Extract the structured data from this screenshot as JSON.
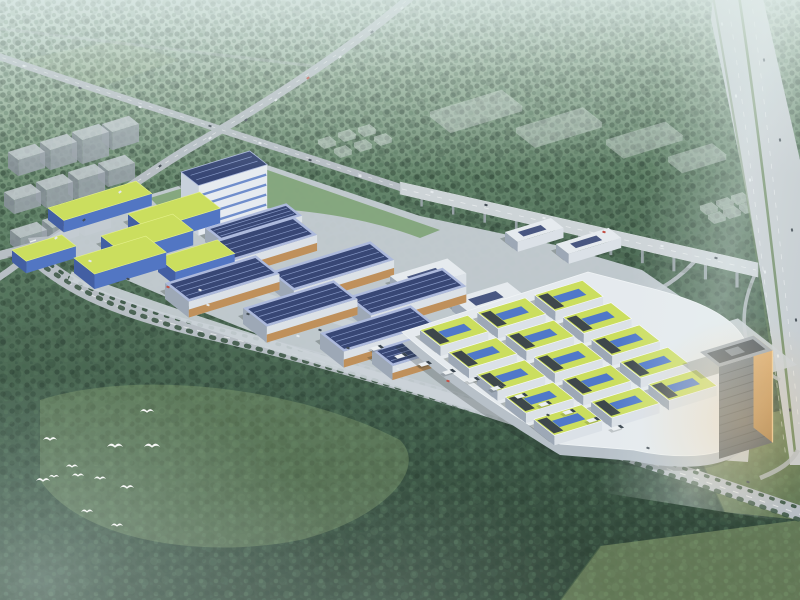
{
  "title": "Aerial rendering of industrial park campus with solar roofs",
  "colors": {
    "grad_0": "#c3d7cd",
    "grad_1": "#8fab90",
    "grad_2": "#5e8064",
    "grad_3": "#46654e",
    "grad_4": "#35523f",
    "grad_5": "#2b4132",
    "tree_a": "#243c2c",
    "tree_b": "#3e5f47",
    "tree_c": "#1f3527",
    "tree_d": "#4a6e52",
    "tree_e": "#31503c",
    "meadow": "#93ad74",
    "field_a": "#8ba268",
    "field_b": "#9cb173",
    "road": "#b6bdc3",
    "road_dash": "#ffffff",
    "highway": "#c6ccd1",
    "viaduct": "#ced4d8",
    "pier": "#98a2a8",
    "median": "#5d7c4e",
    "tree_row": "#2e4a36",
    "inner_road": "#ccd3d9",
    "ground": "#c6cdd4",
    "lawn": "#679455",
    "solar_roof": "#2e3d6e",
    "solar_line": "#8fa2d4",
    "solar_rim": "#aab7dd",
    "hall_facade": "#dde2e9",
    "facade_shade": "#9aa5b4",
    "wood": "#bf8b52",
    "yellow_roof": "#ccdf56",
    "yellow_edge": "#e8f486",
    "panel_blue": "#3f6cd0",
    "blue_facade": "#4a6fc2",
    "blue_facade_dark": "#3a57a0",
    "plinth": "#e8ecf0",
    "plinth_shade": "#b6bfc8",
    "unit_dark": "#2b3440",
    "tower_top": "#6a7580",
    "tower_bottom": "#46505a",
    "tower_floor": "#2e3842",
    "glow_top": "#e8b06a",
    "glow_bottom": "#a87a42",
    "tower_roof": "#9aa3ae",
    "tower_roof_dark": "#39424c",
    "ghost": "#dfe3e5",
    "ghost_edge": "#f2f6f6",
    "city_roof": "#c6ccd2",
    "city_face": "#9aa2ab",
    "city_face_dark": "#868e98",
    "shadow": "#14201a",
    "bird": "#ffffff",
    "truck": "#eef1f4",
    "truck_cab": "#2f3a44",
    "car_w": "#e8ecef",
    "car_d": "#3a434c",
    "car_r": "#c24538",
    "hq_facade": "#e9edf3",
    "hq_facade_side": "#c9d1dd",
    "hq_accent": "#c0392e",
    "plaza": "#c9d0d8"
  },
  "scene": {
    "buildings": [
      {
        "t": "yellowLong",
        "a": [
          48,
          208
        ],
        "l": 92,
        "w": 20,
        "h": 12
      },
      {
        "t": "yellowLong",
        "a": [
          12,
          250
        ],
        "l": 52,
        "w": 18,
        "h": 12
      },
      {
        "t": "solarHall",
        "a": [
          205,
          228
        ],
        "l": 85,
        "w": 20,
        "h": 14
      },
      {
        "t": "hq",
        "a": [
          181,
          172
        ],
        "l": 72,
        "w": 22,
        "h": 50
      },
      {
        "t": "yellowFactory",
        "a": [
          128,
          214
        ],
        "l": 75,
        "w": 26,
        "h": 15
      },
      {
        "t": "yellowFactory",
        "a": [
          101,
          236
        ],
        "l": 75,
        "w": 26,
        "h": 15
      },
      {
        "t": "yellowFactory",
        "a": [
          74,
          258
        ],
        "l": 75,
        "w": 26,
        "h": 15
      },
      {
        "t": "yellowFactory",
        "a": [
          158,
          258
        ],
        "l": 62,
        "w": 22,
        "h": 14
      },
      {
        "t": "solarHall",
        "a": [
          193,
          247
        ],
        "l": 105,
        "w": 30,
        "h": 16
      },
      {
        "t": "solarHall",
        "a": [
          270,
          272
        ],
        "l": 105,
        "w": 30,
        "h": 16
      },
      {
        "t": "solarHall",
        "a": [
          347,
          297
        ],
        "l": 100,
        "w": 30,
        "h": 16
      },
      {
        "t": "solarHall",
        "a": [
          165,
          283
        ],
        "l": 95,
        "w": 30,
        "h": 16
      },
      {
        "t": "solarHall",
        "a": [
          243,
          308
        ],
        "l": 95,
        "w": 30,
        "h": 16
      },
      {
        "t": "solarHall",
        "a": [
          320,
          333
        ],
        "l": 95,
        "w": 30,
        "h": 16
      },
      {
        "t": "whitePod",
        "a": [
          390,
          276
        ],
        "l": 60,
        "w": 24,
        "h": 12
      },
      {
        "t": "whitePod",
        "a": [
          452,
          299
        ],
        "l": 58,
        "w": 22,
        "h": 12
      },
      {
        "t": "solarHall",
        "a": [
          372,
          350
        ],
        "l": 70,
        "w": 26,
        "h": 14
      },
      {
        "t": "whitePod",
        "a": [
          505,
          232
        ],
        "l": 48,
        "w": 16,
        "h": 10
      },
      {
        "t": "whitePod",
        "a": [
          556,
          244
        ],
        "l": 55,
        "w": 16,
        "h": 10
      },
      {
        "t": "plaza",
        "a": [
          628,
          352
        ],
        "l": 115,
        "w": 75,
        "h": 0,
        "z": -80
      },
      {
        "t": "whitePod",
        "a": [
          645,
          352
        ],
        "l": 50,
        "w": 36,
        "h": 14
      },
      {
        "t": "lawnPatch",
        "a": [
          658,
          372
        ],
        "l": 26,
        "w": 18,
        "h": 0
      }
    ],
    "units_grid": {
      "a": [
        420,
        330
      ],
      "cols": 3,
      "rows": 5,
      "l": 50,
      "w": 26,
      "h": 10,
      "sx": 60,
      "sy": 36
    },
    "plinth": {
      "path": "M 402,332 L 588,272 L 642,286 C 724,306 762,330 750,392 L 740,442 C 712,462 660,456 634,450 L 560,444 C 488,400 440,366 402,332 Z",
      "shade_dy": 11
    },
    "tower": {
      "a": [
        700,
        352
      ],
      "l": 56,
      "w": 24,
      "h": 92,
      "floors": 10
    },
    "ghost_pads": [
      [
        430,
        112,
        75,
        26
      ],
      [
        516,
        128,
        70,
        24
      ],
      [
        606,
        140,
        62,
        22
      ],
      [
        668,
        157,
        46,
        18
      ]
    ],
    "ghost_boxes": [
      [
        318,
        140
      ],
      [
        338,
        133
      ],
      [
        358,
        128
      ],
      [
        334,
        149
      ],
      [
        354,
        143
      ],
      [
        374,
        137
      ],
      [
        700,
        206
      ],
      [
        716,
        201
      ],
      [
        731,
        196
      ],
      [
        708,
        215
      ],
      [
        723,
        210
      ],
      [
        739,
        205
      ]
    ],
    "city_blocks": [
      [
        8,
        152,
        16
      ],
      [
        40,
        142,
        20
      ],
      [
        72,
        132,
        24
      ],
      [
        102,
        124,
        18
      ],
      [
        4,
        192,
        14
      ],
      [
        36,
        182,
        18
      ],
      [
        68,
        172,
        22
      ],
      [
        98,
        163,
        16
      ],
      [
        10,
        230,
        14
      ],
      [
        42,
        220,
        16
      ],
      [
        74,
        210,
        18
      ]
    ],
    "trucks": [
      [
        370,
        348
      ],
      [
        394,
        356
      ],
      [
        418,
        364
      ],
      [
        442,
        372
      ],
      [
        466,
        380
      ],
      [
        490,
        388
      ],
      [
        514,
        396
      ],
      [
        538,
        404
      ],
      [
        562,
        412
      ],
      [
        586,
        420
      ],
      [
        610,
        428
      ]
    ],
    "cars": [
      [
        90,
        261,
        "w",
        18
      ],
      [
        128,
        279,
        "d",
        18
      ],
      [
        168,
        287,
        "r",
        18
      ],
      [
        208,
        305,
        "w",
        18
      ],
      [
        248,
        314,
        "d",
        18
      ],
      [
        298,
        336,
        "w",
        18
      ],
      [
        348,
        348,
        "d",
        18
      ],
      [
        398,
        369,
        "w",
        18
      ],
      [
        448,
        381,
        "r",
        18
      ],
      [
        498,
        403,
        "w",
        18
      ],
      [
        548,
        415,
        "d",
        18
      ],
      [
        598,
        437,
        "w",
        18
      ],
      [
        648,
        448,
        "d",
        18
      ],
      [
        698,
        470,
        "w",
        18
      ],
      [
        748,
        482,
        "d",
        18
      ],
      [
        402,
        8,
        "w",
        -37
      ],
      [
        372,
        32,
        "d",
        -37
      ],
      [
        340,
        57,
        "w",
        -37
      ],
      [
        308,
        78,
        "r",
        -37
      ],
      [
        276,
        100,
        "w",
        -37
      ],
      [
        246,
        120,
        "d",
        -37
      ],
      [
        210,
        138,
        "w",
        -37
      ],
      [
        160,
        166,
        "d",
        -37
      ],
      [
        120,
        192,
        "w",
        -37
      ],
      [
        84,
        220,
        "d",
        -37
      ],
      [
        56,
        238,
        "w",
        -37
      ],
      [
        24,
        66,
        "w",
        18
      ],
      [
        80,
        88,
        "d",
        18
      ],
      [
        140,
        107,
        "w",
        18
      ],
      [
        210,
        126,
        "d",
        18
      ],
      [
        260,
        143,
        "w",
        18
      ],
      [
        310,
        160,
        "d",
        18
      ],
      [
        360,
        176,
        "w",
        18
      ],
      [
        432,
        192,
        "w",
        13
      ],
      [
        486,
        205,
        "d",
        13
      ],
      [
        544,
        218,
        "w",
        13
      ],
      [
        604,
        232,
        "r",
        13
      ],
      [
        662,
        246,
        "w",
        13
      ],
      [
        716,
        258,
        "d",
        13
      ],
      [
        722,
        24,
        "w",
        80
      ],
      [
        764,
        60,
        "d",
        80
      ],
      [
        736,
        96,
        "w",
        80
      ],
      [
        780,
        140,
        "d",
        80
      ],
      [
        750,
        180,
        "w",
        80
      ],
      [
        792,
        230,
        "d",
        80
      ],
      [
        765,
        272,
        "w",
        80
      ],
      [
        796,
        320,
        "d",
        80
      ],
      [
        778,
        356,
        "w",
        80
      ],
      [
        790,
        410,
        "d",
        80
      ],
      [
        200,
        290,
        "w",
        18
      ],
      [
        320,
        330,
        "d",
        18
      ],
      [
        470,
        380,
        "w",
        18
      ]
    ],
    "birds": [
      [
        50,
        440,
        7
      ],
      [
        115,
        447,
        8
      ],
      [
        152,
        447,
        8
      ],
      [
        147,
        412,
        7
      ],
      [
        72,
        467,
        6
      ],
      [
        78,
        476,
        6
      ],
      [
        43,
        481,
        7
      ],
      [
        54,
        477,
        5
      ],
      [
        100,
        479,
        6
      ],
      [
        127,
        488,
        7
      ],
      [
        87,
        512,
        6
      ],
      [
        117,
        526,
        6
      ]
    ]
  }
}
